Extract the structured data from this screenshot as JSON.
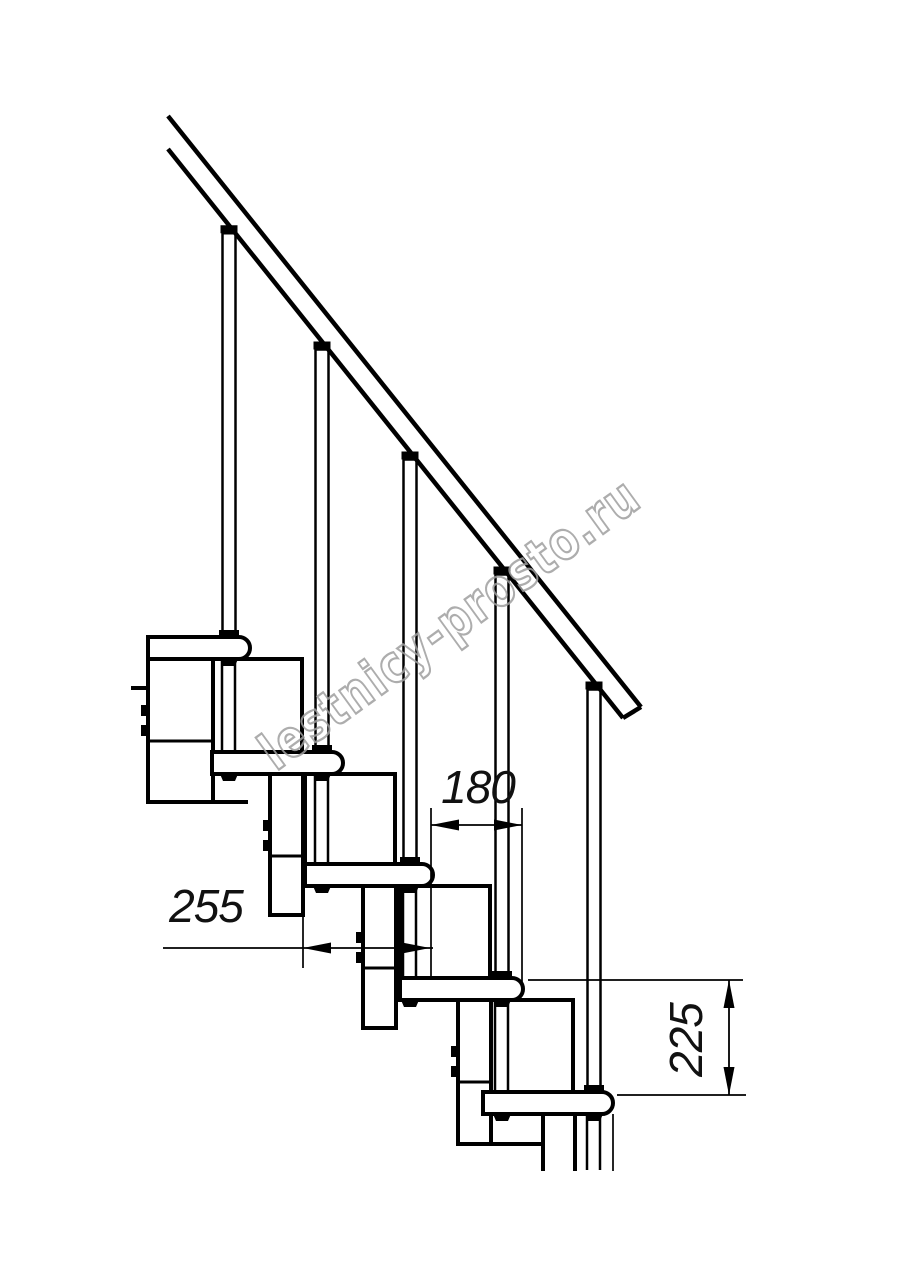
{
  "title": "Modular staircase side-view technical drawing",
  "colors": {
    "line": "#000000",
    "background": "#ffffff",
    "watermark": "#9f9f9f"
  },
  "watermark": {
    "text": "lestnicy-prosto.ru"
  },
  "dimensions": {
    "d180": {
      "label": "180",
      "orientation": "horizontal"
    },
    "d255": {
      "label": "255",
      "orientation": "horizontal"
    },
    "d225": {
      "label": "225",
      "orientation": "vertical"
    }
  },
  "drawing": {
    "canvas": {
      "w": 914,
      "h": 1280
    },
    "rail": {
      "upper": [
        168,
        116,
        641,
        707
      ],
      "lower": [
        168,
        149,
        623,
        718
      ],
      "endcut": [
        641,
        707,
        623,
        718
      ],
      "stroke": 4.5
    },
    "rail_lower_edge": {
      "slope": 1.25,
      "intercept": -61
    },
    "tread_h": 22,
    "tread_r": 11,
    "treads": [
      {
        "x": 148,
        "y": 637,
        "w": 102
      },
      {
        "x": 212,
        "y": 752,
        "w": 131
      },
      {
        "x": 305,
        "y": 864,
        "w": 128
      },
      {
        "x": 400,
        "y": 978,
        "w": 123
      },
      {
        "x": 483,
        "y": 1092,
        "w": 130
      }
    ],
    "boxes": [
      {
        "x": 212,
        "y": 659,
        "w": 90,
        "h": 93
      },
      {
        "x": 305,
        "y": 774,
        "w": 90,
        "h": 90
      },
      {
        "x": 400,
        "y": 886,
        "w": 90,
        "h": 92
      },
      {
        "x": 483,
        "y": 1000,
        "w": 90,
        "h": 92
      }
    ],
    "columns": [
      {
        "x": 148,
        "x2": 213,
        "top": 659,
        "bot": 802,
        "divider": 741,
        "bolts": [
          705,
          725
        ],
        "bottomRight": 248,
        "stub": [
          131,
          688
        ]
      },
      {
        "x": 270,
        "x2": 303,
        "top": 774,
        "bot": 915,
        "divider": 856,
        "bolts": [
          820,
          840
        ]
      },
      {
        "x": 363,
        "x2": 396,
        "top": 886,
        "bot": 1028,
        "divider": 968,
        "bolts": [
          932,
          952
        ]
      },
      {
        "x": 458,
        "x2": 491,
        "top": 1000,
        "bot": 1144,
        "divider": 1082,
        "bolts": [
          1046,
          1066
        ],
        "bottomRight": 545
      },
      {
        "x": 543,
        "x2": 575,
        "top": 1114,
        "bot": 1171,
        "open": true
      }
    ],
    "balusters": [
      {
        "cx": 229,
        "foot": 637
      },
      {
        "cx": 322,
        "foot": 752
      },
      {
        "cx": 410,
        "foot": 864
      },
      {
        "cx": 502,
        "foot": 978
      },
      {
        "cx": 594,
        "foot": 1092
      }
    ],
    "rods": [
      {
        "x": 222,
        "y1": 659,
        "y2": 752
      },
      {
        "x": 315,
        "y1": 774,
        "y2": 864
      },
      {
        "x": 403,
        "y1": 886,
        "y2": 978
      },
      {
        "x": 495,
        "y1": 1000,
        "y2": 1092
      },
      {
        "x": 587,
        "y1": 1114,
        "y2": 1170
      }
    ],
    "nuts": [
      {
        "cx": 229,
        "y": 659
      },
      {
        "cx": 229,
        "y": 774
      },
      {
        "cx": 322,
        "y": 774
      },
      {
        "cx": 322,
        "y": 886
      },
      {
        "cx": 410,
        "y": 886
      },
      {
        "cx": 410,
        "y": 1000
      },
      {
        "cx": 502,
        "y": 1000
      },
      {
        "cx": 502,
        "y": 1114
      },
      {
        "cx": 594,
        "y": 1114
      }
    ],
    "thin_lines": [
      [
        613,
        1114,
        613,
        1171
      ]
    ],
    "dims": {
      "d180": {
        "line": [
          431,
          825,
          522,
          825
        ],
        "arrows": [
          {
            "x": 431,
            "y": 825,
            "dir": "left"
          },
          {
            "x": 522,
            "y": 825,
            "dir": "right"
          }
        ],
        "ext": [
          [
            431,
            808,
            431,
            980
          ],
          [
            522,
            808,
            522,
            992
          ]
        ]
      },
      "d255": {
        "line": [
          163,
          948,
          433,
          948
        ],
        "arrows": [
          {
            "x": 303,
            "y": 948,
            "dir": "left"
          },
          {
            "x": 430,
            "y": 948,
            "dir": "right"
          }
        ],
        "ext": [
          [
            303,
            916,
            303,
            968
          ]
        ]
      },
      "d225": {
        "line": [
          729,
          980,
          729,
          1095
        ],
        "arrows": [
          {
            "x": 729,
            "y": 980,
            "dir": "up"
          },
          {
            "x": 729,
            "y": 1095,
            "dir": "down"
          }
        ],
        "ext": [
          [
            528,
            980,
            743,
            980
          ],
          [
            617,
            1095,
            746,
            1095
          ]
        ]
      }
    }
  }
}
